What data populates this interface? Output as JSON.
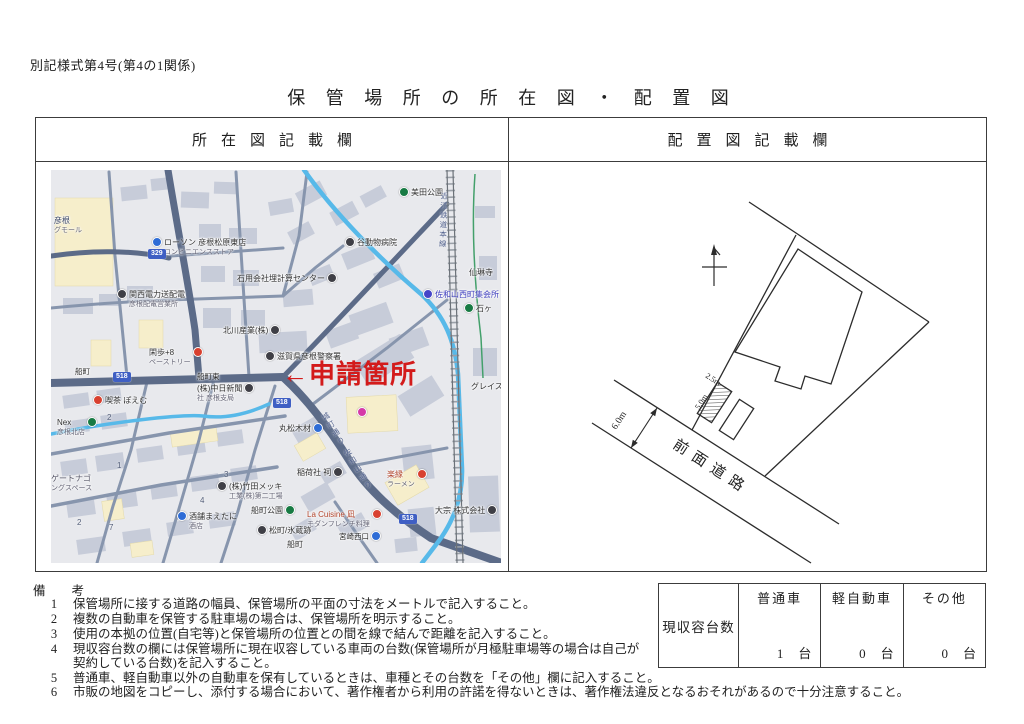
{
  "form": {
    "form_number": "別記様式第4号(第4の1関係)",
    "title": "保 管 場 所 の 所 在 図 ・ 配 置 図",
    "left_header": "所在図記載欄",
    "right_header": "配置図記載欄"
  },
  "map": {
    "annotation": "←申請箇所",
    "labels": [
      {
        "name": "mall-label",
        "text": "彦根",
        "sub": "グモール",
        "x": 3,
        "y": 46,
        "tc": "#3a4668"
      },
      {
        "name": "convenience-store-label",
        "icon": "convenience-store-icon",
        "icon_color": "#2e6cd6",
        "icon_pos": "before",
        "text": "ローソン 彦根松原東店",
        "sub": "コンビニエンスストア",
        "x": 101,
        "y": 68
      },
      {
        "name": "park-label",
        "icon": "park-icon",
        "icon_color": "#177a43",
        "icon_pos": "before",
        "text": "美田公園",
        "x": 348,
        "y": 18
      },
      {
        "name": "animal-hospital-label",
        "icon": "hospital-icon",
        "icon_color": "#3f3f46",
        "icon_pos": "before",
        "text": "谷動物病院",
        "x": 294,
        "y": 68
      },
      {
        "name": "office-label",
        "icon": "office-icon",
        "icon_color": "#3f3f46",
        "icon_pos": "after",
        "text": "石用会社埋計算センター",
        "x": 186,
        "y": 104
      },
      {
        "name": "temple-label",
        "text": "仙琳寺",
        "x": 418,
        "y": 98
      },
      {
        "name": "meeting-hall-label",
        "icon": "hall-icon",
        "icon_color": "#4545c8",
        "icon_pos": "before",
        "text": "佐和山西町集会所",
        "x": 372,
        "y": 120,
        "tc": "#3b3bbd"
      },
      {
        "name": "power-office-label",
        "icon": "office-icon",
        "icon_color": "#3f3f46",
        "icon_pos": "before",
        "text": "関西電力送配電",
        "sub": "彦根配電営業所",
        "x": 66,
        "y": 120
      },
      {
        "name": "company-label",
        "icon": "office-icon",
        "icon_color": "#3f3f46",
        "icon_pos": "after",
        "text": "北川産業(株)",
        "x": 172,
        "y": 156
      },
      {
        "name": "pastry-label",
        "icon": "restaurant-icon",
        "icon_color": "#d8402f",
        "icon_pos": "after",
        "text": "閑歩+8",
        "sub": "ペーストリー",
        "x": 98,
        "y": 178
      },
      {
        "name": "bus-stop-label",
        "cls": "bus",
        "text": "船町",
        "x": 24,
        "y": 197
      },
      {
        "name": "bus-stop-label",
        "cls": "bus",
        "text": "船町東",
        "x": 146,
        "y": 202
      },
      {
        "name": "cafe-label",
        "icon": "cafe-icon",
        "icon_color": "#d8402f",
        "icon_pos": "before",
        "text": "喫茶 ぽえむ",
        "x": 42,
        "y": 226
      },
      {
        "name": "police-station-label",
        "icon": "police-icon",
        "icon_color": "#3f3f46",
        "icon_pos": "before",
        "text": "滋賀県彦根警察署",
        "x": 214,
        "y": 182
      },
      {
        "name": "newspaper-label",
        "icon": "office-icon",
        "icon_color": "#3f3f46",
        "icon_pos": "after",
        "text": "(株)中日新聞",
        "sub": "社 彦根支局",
        "x": 146,
        "y": 214
      },
      {
        "name": "lumber-label",
        "icon": "shop-icon",
        "icon_color": "#2e6cd6",
        "icon_pos": "after",
        "text": "丸松木材",
        "x": 228,
        "y": 254
      },
      {
        "name": "store-label",
        "icon": "store-icon",
        "icon_color": "#d539a8",
        "text": "",
        "x": 306,
        "y": 238
      },
      {
        "name": "shrine-label",
        "icon": "shrine-icon",
        "icon_color": "#3f3f46",
        "icon_pos": "after",
        "text": "稲荷社 祠",
        "x": 246,
        "y": 298
      },
      {
        "name": "ramen-label",
        "icon": "restaurant-icon",
        "icon_color": "#d8402f",
        "icon_pos": "after",
        "text": "楽縁",
        "sub": "ラーメン",
        "x": 336,
        "y": 300,
        "tc": "#b2452c"
      },
      {
        "name": "restaurant-label",
        "icon": "restaurant-icon",
        "icon_color": "#d8402f",
        "icon_pos": "after",
        "text": "La Cuisine 凪",
        "sub": "モダンフレンチ料理",
        "x": 256,
        "y": 340,
        "tc": "#b2452c"
      },
      {
        "name": "bus-stop-label",
        "cls": "bus",
        "icon": "bus-stop-icon",
        "icon_color": "#2e6cd6",
        "icon_pos": "after",
        "text": "宮崎西口",
        "x": 288,
        "y": 362
      },
      {
        "name": "district-label",
        "text": "船町",
        "x": 236,
        "y": 370
      },
      {
        "name": "storehouse-label",
        "icon": "poi-icon",
        "icon_color": "#3f3f46",
        "icon_pos": "before",
        "text": "松町/氷蔵跡",
        "x": 206,
        "y": 356
      },
      {
        "name": "park-label",
        "icon": "park-icon",
        "icon_color": "#177a43",
        "icon_pos": "after",
        "text": "船町公園",
        "x": 200,
        "y": 336
      },
      {
        "name": "company-label",
        "icon": "office-icon",
        "icon_color": "#3f3f46",
        "icon_pos": "after",
        "text": "大宗 株式会社",
        "x": 384,
        "y": 336
      },
      {
        "name": "plating-factory-label",
        "icon": "factory-icon",
        "icon_color": "#3f3f46",
        "icon_pos": "before",
        "text": "(株)竹田メッキ",
        "sub": "工業(株)第二工場",
        "x": 166,
        "y": 312
      },
      {
        "name": "liquor-shop-label",
        "icon": "shop-icon",
        "icon_color": "#2e6cd6",
        "icon_pos": "before",
        "text": "酒舗まえたに",
        "sub": "酒店",
        "x": 126,
        "y": 342
      },
      {
        "name": "convenience-store-label",
        "icon": "store-icon",
        "icon_color": "#177a43",
        "icon_pos": "after",
        "text": "Nex",
        "sub": "彦根北店",
        "x": 6,
        "y": 248
      },
      {
        "name": "parking-label",
        "text": "ゲートナゴ",
        "sub": "ングスペース",
        "x": 0,
        "y": 304,
        "tc": "#556"
      },
      {
        "name": "apartment-label",
        "text": "グレイスハ",
        "x": 420,
        "y": 212
      },
      {
        "name": "poi-label",
        "icon": "poi-icon",
        "icon_color": "#177a43",
        "icon_pos": "before",
        "text": "石ヶ",
        "x": 413,
        "y": 134
      }
    ],
    "badges": [
      {
        "text": "329",
        "x": 97,
        "y": 79
      },
      {
        "text": "518",
        "x": 62,
        "y": 202
      },
      {
        "text": "518",
        "x": 222,
        "y": 228
      },
      {
        "text": "518",
        "x": 348,
        "y": 344
      }
    ],
    "numbers": [
      {
        "t": "1",
        "x": 66,
        "y": 291
      },
      {
        "t": "2",
        "x": 56,
        "y": 243
      },
      {
        "t": "2",
        "x": 26,
        "y": 348
      },
      {
        "t": "3",
        "x": 173,
        "y": 300
      },
      {
        "t": "4",
        "x": 149,
        "y": 326
      },
      {
        "t": "7",
        "x": 58,
        "y": 353
      }
    ],
    "vertical_texts": [
      {
        "name": "railway-name-label",
        "text": "近江鉄道本線",
        "x": 388,
        "y": 22,
        "rot": 2
      },
      {
        "name": "road-name-label",
        "text": "城町通り",
        "x": 268,
        "y": 246,
        "rot": -32
      },
      {
        "name": "road-name-label",
        "text": "佐和山通り",
        "x": 290,
        "y": 282,
        "rot": -32
      }
    ]
  },
  "diagram": {
    "road_label": "前面道路",
    "dim_road": "6.0m",
    "dim_width": "2.5m",
    "dim_length": "5.0m"
  },
  "remarks": {
    "header_left": "備",
    "header_right": "考",
    "notes": [
      {
        "no": "1",
        "text": "保管場所に接する道路の幅員、保管場所の平面の寸法をメートルで記入すること。"
      },
      {
        "no": "2",
        "text": "複数の自動車を保管する駐車場の場合は、保管場所を明示すること。"
      },
      {
        "no": "3",
        "text": "使用の本拠の位置(自宅等)と保管場所の位置との間を線で結んで距離を記入すること。"
      },
      {
        "no": "4",
        "text": "現収容台数の欄には保管場所に現在収容している車両の台数(保管場所が月極駐車場等の場合は自己が契約している台数)を記入すること。"
      },
      {
        "no": "5",
        "text": "普通車、軽自動車以外の自動車を保有しているときは、車種とその台数を「その他」欄に記入すること。"
      },
      {
        "no": "6",
        "text": "市販の地図をコピーし、添付する場合において、著作権者から利用の許諾を得ないときは、著作権法違反となるおそれがあるので十分注意すること。"
      }
    ]
  },
  "capacity": {
    "row_label": "現収容台数",
    "columns": [
      {
        "label": "普通車",
        "value": "1",
        "unit": "台"
      },
      {
        "label": "軽自動車",
        "value": "0",
        "unit": "台"
      },
      {
        "label": "その他",
        "value": "0",
        "unit": "台"
      }
    ]
  }
}
